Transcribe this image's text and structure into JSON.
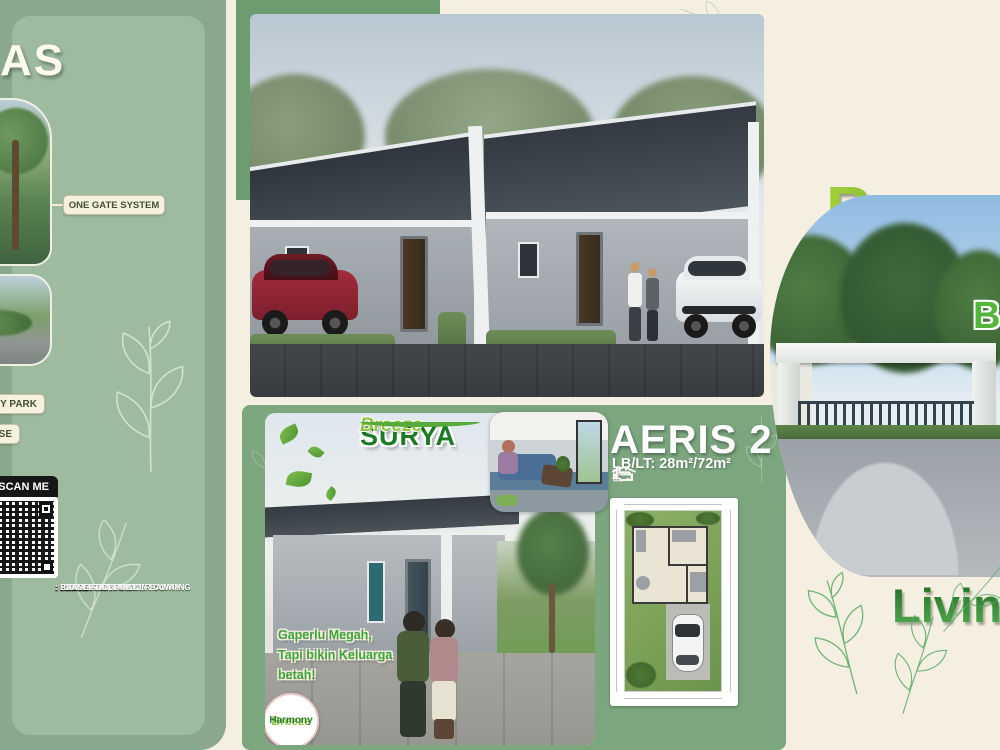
{
  "page": {
    "background": "#F5EFE2"
  },
  "colors": {
    "left_panel_green": "#9EBB9F",
    "left_panel_edge_green": "#8AA98C",
    "mid_accent_green": "#6E9C71",
    "bottom_panel_green": "#7BA67E",
    "brand_green": "#2F8A2F",
    "accent_lime": "#8CC63F",
    "cream": "#F5EFE2"
  },
  "left_panel": {
    "title_partial": "AS",
    "facility_labels": {
      "one_gate": "ONE GATE SYSTEM",
      "park_partial": "NY PARK",
      "house_partial": "OUSE"
    },
    "qr": {
      "scan_me": "SCAN ME"
    },
    "specs": [
      ": ALUMUNIUM POWDER COATING",
      ": PANEL FABRIKASI",
      ": PANEL FABRIKASI",
      ": ALUMUNIUM POWDER COATING",
      ": SHOWER",
      ": CLOSET DUDUK",
      ": PVC",
      ": 1300 VA",
      ": PDAM",
      ": BIO SEPTIC, TANDON BAWAH"
    ]
  },
  "brochure": {
    "logo": {
      "line1": "SURYA",
      "line2": "Breeze"
    },
    "tagline": {
      "line1": "Gaperlu Megah,",
      "line2": "Tapi bikin Keluarga",
      "line3": "betah!"
    },
    "badge": {
      "line1": "Breeze",
      "line2": "Harmony"
    },
    "unit": {
      "name": "AERIS 2",
      "size": "LB/LT: 28m²/72m²",
      "bedrooms": "2",
      "bathrooms": "1",
      "carports": "1"
    }
  },
  "right_panel": {
    "headline": "Breeze",
    "headline_partial": "B",
    "subheadline": "Living"
  }
}
